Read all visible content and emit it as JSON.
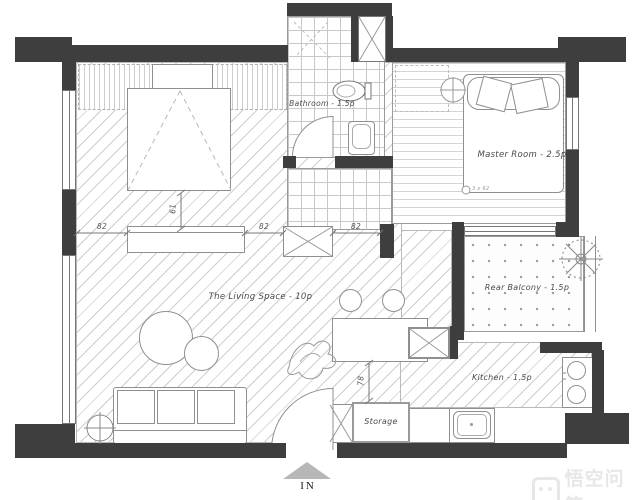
{
  "rooms": {
    "bathroom": "Bathroom - 1.5p",
    "master": "Master Room - 2.5p",
    "master_note": "3 x 62",
    "living": "The Living Space - 10p",
    "balcony": "Rear Balcony - 1.5p",
    "kitchen": "Kitchen - 1.5p",
    "storage": "Storage"
  },
  "dimensions": {
    "wall_left": "82",
    "wall_mid": "82",
    "wall_right": "82",
    "bed_offset": "61",
    "hall_width": "78"
  },
  "entrance": {
    "label": "IN"
  },
  "watermark": {
    "text": "悟空问答"
  },
  "colors": {
    "wall": "#3e3e3e",
    "line": "#8f8f8f",
    "watermark": "#e7e7e7"
  }
}
